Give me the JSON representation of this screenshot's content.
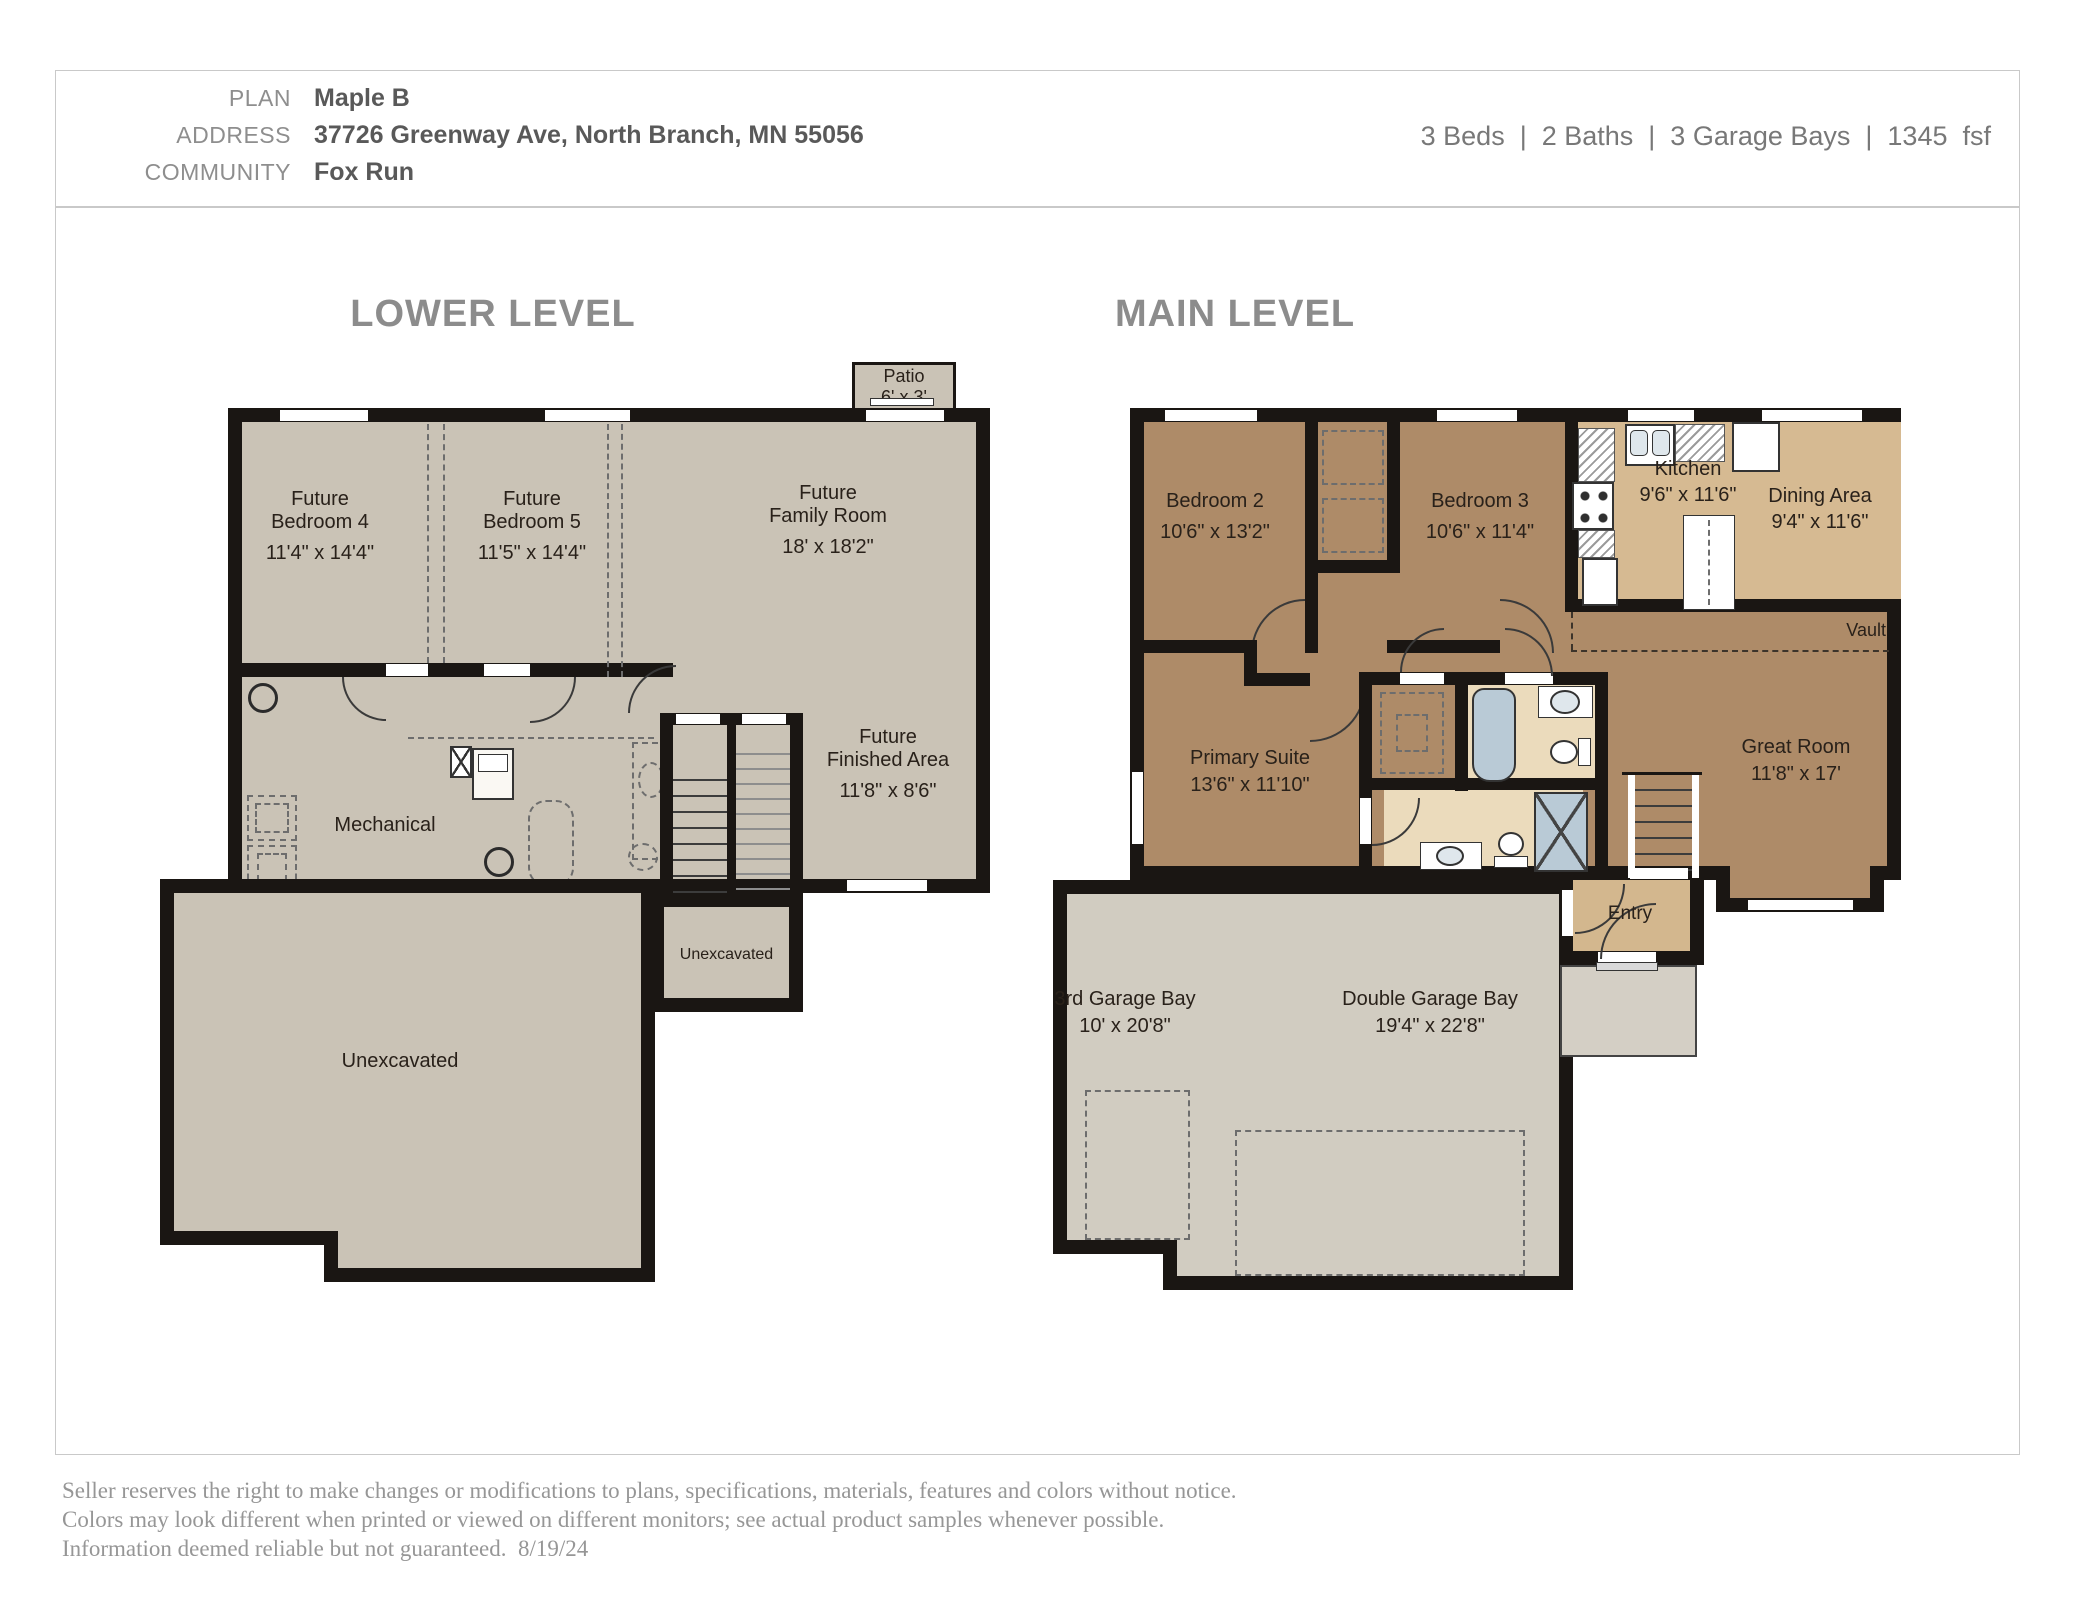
{
  "header": {
    "plan_label": "PLAN",
    "plan_value": "Maple B",
    "address_label": "ADDRESS",
    "address_value": "37726 Greenway Ave, North Branch, MN 55056",
    "community_label": "COMMUNITY",
    "community_value": "Fox Run",
    "stats": "3 Beds  |  2 Baths  |  3 Garage Bays  |  1345  fsf"
  },
  "levels": {
    "lower": {
      "title": "LOWER LEVEL",
      "rooms": {
        "patio": {
          "name": "Patio",
          "dims": "6' x 3'"
        },
        "bedroom4": {
          "prefix": "Future",
          "name": "Bedroom 4",
          "dims": "11'4\" x 14'4\""
        },
        "bedroom5": {
          "prefix": "Future",
          "name": "Bedroom 5",
          "dims": "11'5\" x 14'4\""
        },
        "family_room": {
          "prefix": "Future",
          "name": "Family Room",
          "dims": "18' x 18'2\""
        },
        "mechanical": {
          "name": "Mechanical"
        },
        "finished_area": {
          "prefix": "Future",
          "name": "Finished Area",
          "dims": "11'8\" x 8'6\""
        },
        "unexcavated_small": {
          "name": "Unexcavated"
        },
        "unexcavated_large": {
          "name": "Unexcavated"
        }
      }
    },
    "main": {
      "title": "MAIN LEVEL",
      "rooms": {
        "bedroom2": {
          "name": "Bedroom 2",
          "dims": "10'6\" x 13'2\""
        },
        "bedroom3": {
          "name": "Bedroom 3",
          "dims": "10'6\" x 11'4\""
        },
        "kitchen": {
          "name": "Kitchen",
          "dims": "9'6\" x 11'6\""
        },
        "dining": {
          "name": "Dining Area",
          "dims": "9'4\" x 11'6\""
        },
        "vault": {
          "name": "Vault"
        },
        "great_room": {
          "name": "Great Room",
          "dims": "11'8\" x 17'"
        },
        "primary": {
          "name": "Primary Suite",
          "dims": "13'6\" x 11'10\""
        },
        "entry": {
          "name": "Entry"
        },
        "garage_third": {
          "name": "3rd Garage Bay",
          "dims": "10' x 20'8\""
        },
        "garage_double": {
          "name": "Double Garage Bay",
          "dims": "19'4\" x 22'8\""
        }
      }
    }
  },
  "footer": {
    "line1": "Seller reserves the right to make changes or modifications to plans, specifications, materials, features and colors without notice.",
    "line2": "Colors may look different when printed or viewed on different monitors; see actual product samples whenever possible.",
    "line3": "Information deemed reliable but not guaranteed.  8/19/24"
  },
  "colors": {
    "wall": "#1a1613",
    "lower_floor": "#cac3b6",
    "main_brown": "#ae8b68",
    "light_tan": "#d6ba92",
    "bath_cream": "#ebdbbc",
    "garage_grey": "#d1ccc1",
    "fixture_blue": "#b9cad6",
    "title_grey": "#8c8c8c"
  }
}
